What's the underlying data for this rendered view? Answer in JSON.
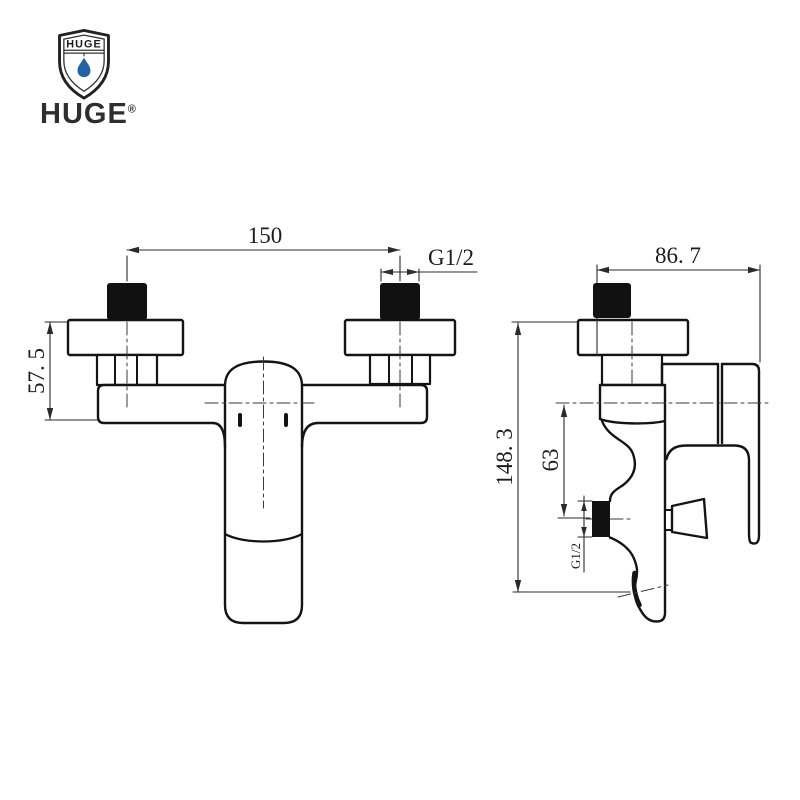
{
  "logo": {
    "shield_text": "HUGE",
    "wordmark": "HUGE",
    "registered": "®",
    "drop_color": "#2263a8",
    "text_color": "#2e2e2e"
  },
  "drawing": {
    "line_color": "#141414",
    "dim_color": "#2a2a2a",
    "front_view": {
      "width_between_inlets": "150",
      "inlet_thread": "G1/2",
      "body_height": "57. 5"
    },
    "side_view": {
      "depth": "86. 7",
      "total_height": "148. 3",
      "outlet_offset": "63",
      "outlet_thread": "G1/2"
    }
  }
}
